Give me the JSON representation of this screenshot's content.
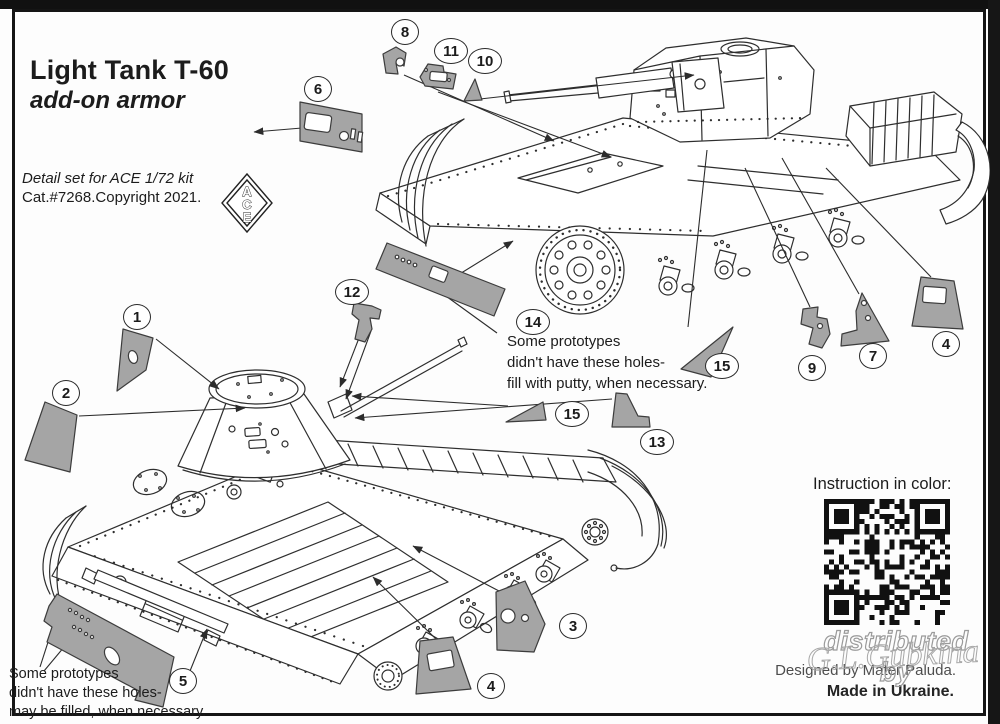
{
  "header": {
    "title": "Light Tank T-60",
    "subtitle": "add-on armor",
    "detail_line1": "Detail set for ACE 1/72 kit",
    "detail_line2": "Cat.#7268.Copyright 2021."
  },
  "logo": {
    "letters": [
      "A",
      "C",
      "E"
    ]
  },
  "notes": {
    "top": [
      "Some prototypes",
      "didn't have these holes-",
      "fill with putty, when necessary."
    ],
    "bottom": [
      "Some prototypes",
      "didn't have these holes-",
      "may be filled, when necessary."
    ]
  },
  "callouts": [
    {
      "n": "1",
      "x": 137,
      "y": 317
    },
    {
      "n": "2",
      "x": 66,
      "y": 393
    },
    {
      "n": "3",
      "x": 573,
      "y": 626
    },
    {
      "n": "4",
      "x": 491,
      "y": 686
    },
    {
      "n": "4",
      "x": 946,
      "y": 344
    },
    {
      "n": "5",
      "x": 183,
      "y": 681
    },
    {
      "n": "6",
      "x": 318,
      "y": 89
    },
    {
      "n": "7",
      "x": 873,
      "y": 356
    },
    {
      "n": "8",
      "x": 405,
      "y": 32
    },
    {
      "n": "9",
      "x": 812,
      "y": 368
    },
    {
      "n": "10",
      "x": 485,
      "y": 61
    },
    {
      "n": "11",
      "x": 451,
      "y": 51
    },
    {
      "n": "12",
      "x": 352,
      "y": 292
    },
    {
      "n": "13",
      "x": 657,
      "y": 442
    },
    {
      "n": "14",
      "x": 533,
      "y": 322
    },
    {
      "n": "15",
      "x": 722,
      "y": 366
    },
    {
      "n": "15",
      "x": 572,
      "y": 414
    }
  ],
  "footer": {
    "instruction_label": "Instruction in color:",
    "watermark_text": "distributed by",
    "watermark_script": "G.L.Gubkina",
    "designed_by": "Designed by Mater Paluda.",
    "made_in": "Made in Ukraine."
  },
  "colors": {
    "part_fill": "#a5a5a5",
    "part_outline": "#3c3c3c",
    "line_art": "#2e2e2e",
    "frame": "#151515"
  }
}
